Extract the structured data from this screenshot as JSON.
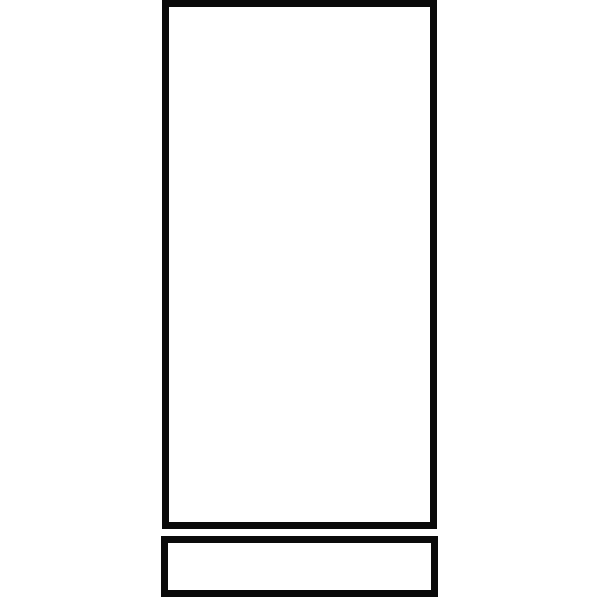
{
  "canvas": {
    "width": 600,
    "height": 600,
    "background": "#ffffff"
  },
  "colors": {
    "stroke": "#0a0a0a",
    "fill": "#ffffff"
  },
  "shapes": [
    {
      "id": "large-vertical-rectangle",
      "x": 162,
      "y": 0,
      "width": 275,
      "height": 529,
      "stroke": "#0a0a0a",
      "stroke_width": 7,
      "fill": "#ffffff"
    },
    {
      "id": "small-horizontal-rectangle",
      "x": 161,
      "y": 536,
      "width": 277,
      "height": 61,
      "stroke": "#0a0a0a",
      "stroke_width": 7,
      "fill": "#ffffff"
    }
  ]
}
